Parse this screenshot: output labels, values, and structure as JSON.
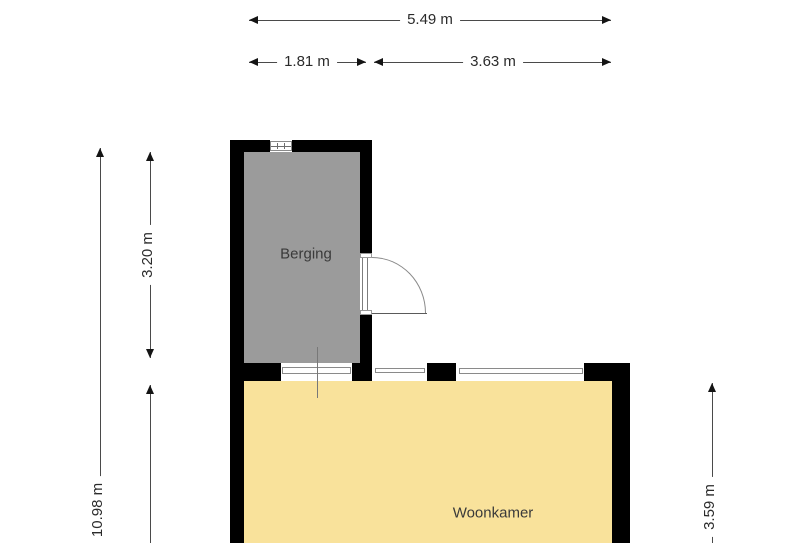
{
  "floorplan": {
    "rooms": [
      {
        "name": "Berging",
        "fill": "#9b9b9b"
      },
      {
        "name": "Woonkamer",
        "fill": "#f9e29b"
      }
    ],
    "dimensions": {
      "top_total": "5.49 m",
      "top_left": "1.81 m",
      "top_right": "3.63 m",
      "left_total": "10.98 m",
      "left_upper": "3.20 m",
      "right_lower": "3.59 m"
    },
    "colors": {
      "wall": "#000000",
      "background": "#ffffff",
      "dimension_text": "#2b2b2b"
    }
  }
}
